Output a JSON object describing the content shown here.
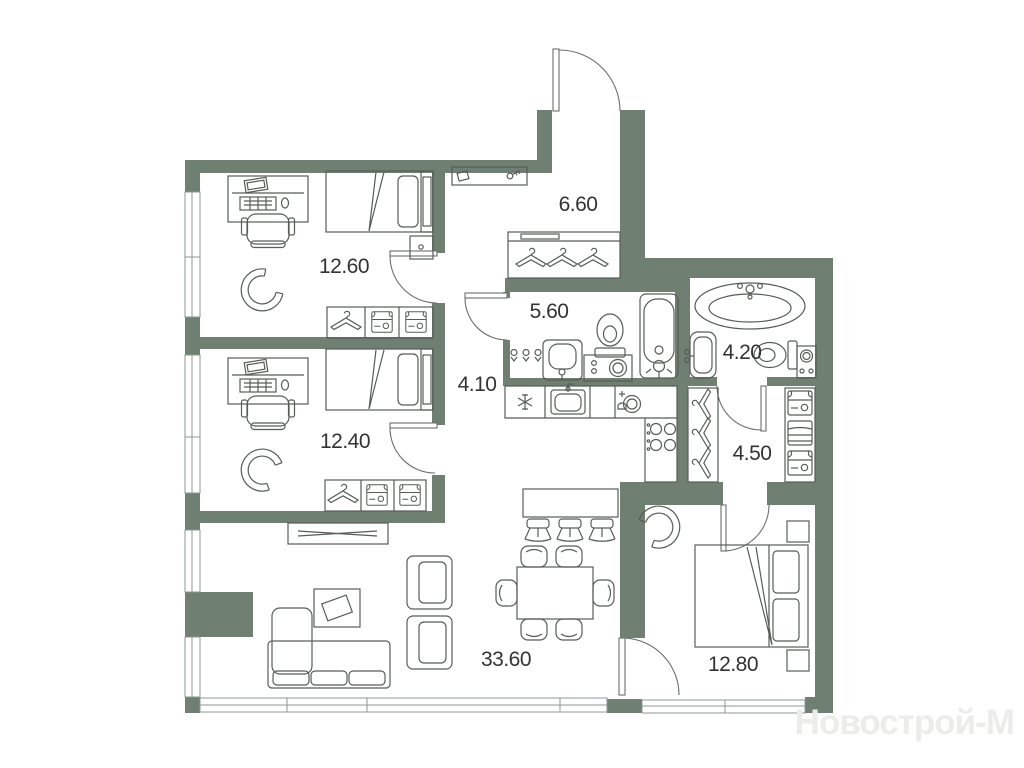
{
  "plan": {
    "watermark": "Новострой-М",
    "rooms": [
      {
        "id": "bedroom-top",
        "area": "12.60"
      },
      {
        "id": "entrance-hall",
        "area": "6.60"
      },
      {
        "id": "bathroom-main",
        "area": "5.60"
      },
      {
        "id": "bathroom-master",
        "area": "4.20"
      },
      {
        "id": "corridor",
        "area": "4.10"
      },
      {
        "id": "bedroom-middle",
        "area": "12.40"
      },
      {
        "id": "walk-in-closet",
        "area": "4.50"
      },
      {
        "id": "living-kitchen",
        "area": "33.60"
      },
      {
        "id": "bedroom-master",
        "area": "12.80"
      }
    ],
    "colors": {
      "wall": "#6F7F72",
      "furniture_line": "#565D57",
      "label_text": "#333333",
      "watermark_text": "#ECECEA",
      "background": "#FFFFFF"
    }
  }
}
